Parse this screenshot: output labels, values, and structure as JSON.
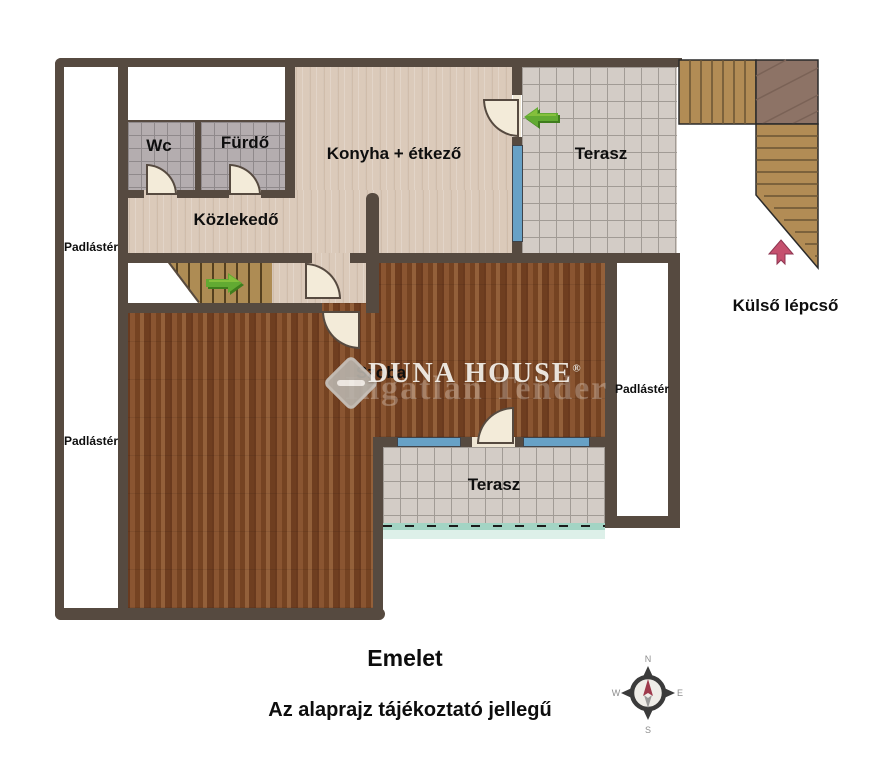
{
  "plan": {
    "rooms": {
      "wc": "Wc",
      "furdo": "Fürdő",
      "kozlekedo": "Közlekedő",
      "konyha": "Konyha + étkező",
      "terasz_felso": "Terasz",
      "szoba": "Szoba",
      "terasz_also": "Terasz"
    },
    "attic": {
      "left_upper": "Padlástér",
      "left_lower": "Padlástér",
      "right": "Padlástér"
    },
    "exterior": {
      "kulso_lepcso": "Külső lépcső"
    },
    "watermark": {
      "brand": "DUNA HOUSE",
      "registered": "®",
      "secondary": "Ingatlan Tender"
    },
    "footer": {
      "title": "Emelet",
      "disclaimer": "Az alaprajz tájékoztató jellegű"
    },
    "compass": {
      "n": "N",
      "e": "E",
      "s": "S",
      "w": "W"
    },
    "colors": {
      "wall": "#564a40",
      "light_wood": "#dbcaba",
      "dark_wood": "#7d4827",
      "bath_tile": "#b4adaf",
      "terrace_tile": "#d3ccc6",
      "window_blue": "#67a1c6",
      "terrace_edge_teal": "#a3d4c4",
      "stair_wood": "#ae8c54",
      "stair_landing": "#8d7366",
      "arrow_green": "#5ba12c",
      "arrow_red": "#c5506e",
      "text": "#0e0e0e"
    }
  }
}
